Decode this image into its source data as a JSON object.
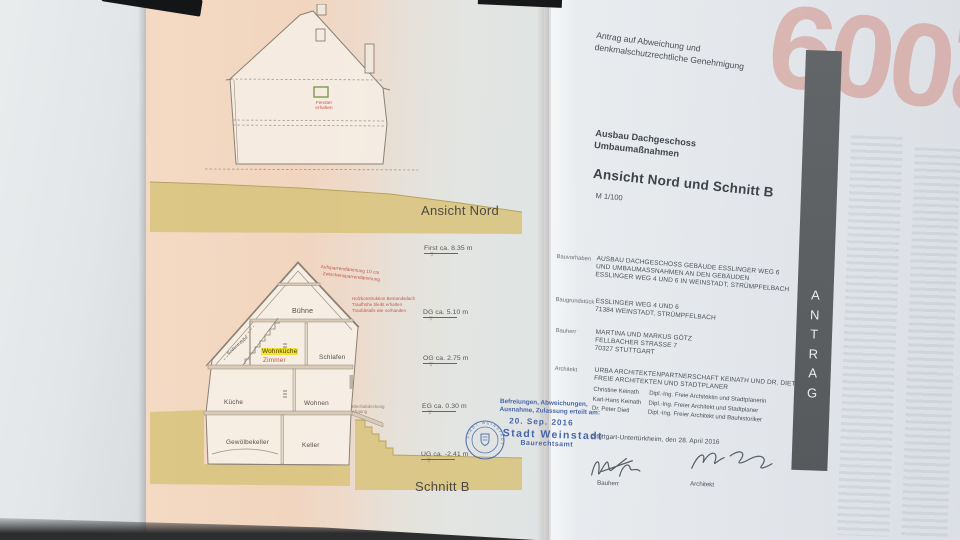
{
  "colors": {
    "page_pink": "#f2d6c0",
    "page_blue_white": "#e4e8ec",
    "ground_ochre": "#d9c480",
    "stamp_blue": "#3b5ca6",
    "annotation_red": "#c0524a",
    "highlight_yellow": "#f2e138",
    "tab_gray": "#5d6163",
    "ghost_red": "#d0867a"
  },
  "elevation": {
    "title": "Ansicht Nord",
    "window_note_line1": "Fenster",
    "window_note_line2": "erhalten"
  },
  "section": {
    "title": "Schnitt B",
    "rooms": {
      "attic": "Bühne",
      "kitchen_living": "Wohnküche",
      "room": "Zimmer",
      "sleeping": "Schlafen",
      "kitchen": "Küche",
      "living": "Wohnen",
      "vault_cellar": "Gewölbekeller",
      "cellar": "Keller",
      "stair": "Bodentreppe"
    },
    "notes": {
      "roof1": "Aufsparrendämmung 10 cm",
      "roof2": "Zwischensparrendämmung",
      "eaves1": "Holzkonstruktion Bestandsdach",
      "eaves2": "Traufhöhe bleibt erhalten",
      "eaves3": "Traufdetails wie vorhanden",
      "exit": "Blechabdeckung Abgang"
    }
  },
  "levels": [
    {
      "name": "First",
      "height": "ca. 8.35 m"
    },
    {
      "name": "DG",
      "height": "ca. 5.10 m"
    },
    {
      "name": "OG",
      "height": "ca. 2.75 m"
    },
    {
      "name": "EG",
      "height": "ca. 0.30 m"
    },
    {
      "name": "UG",
      "height": "ca. -2.41 m"
    }
  ],
  "datum_icon": "▽",
  "stamp": {
    "line1": "Befreiungen, Abweichungen,",
    "line2": "Ausnahme, Zulassung erteilt am:",
    "date": "20. Sep. 2016",
    "authority": "Stadt Weinstadt",
    "office": "Baurechtsamt",
    "seal": "STADT WEINSTADT"
  },
  "form": {
    "request_line1": "Antrag auf Abweichung und",
    "request_line2": "denkmalschutzrechtliche Genehmigung",
    "project_line1": "Ausbau Dachgeschoss",
    "project_line2": "Umbaumaßnahmen",
    "sheet_title": "Ansicht Nord und Schnitt B",
    "scale": "M 1/100",
    "fields": [
      {
        "label": "Bauvorhaben",
        "lines": [
          "AUSBAU DACHGESCHOSS GEBÄUDE ESSLINGER WEG 6",
          "UND UMBAUMASSNAHMEN AN DEN GEBÄUDEN",
          "ESSLINGER WEG 4 UND 6 IN WEINSTADT, STRÜMPFELBACH"
        ]
      },
      {
        "label": "Baugrundstück",
        "lines": [
          "ESSLINGER WEG 4 UND 6",
          "71384 WEINSTADT, STRÜMPFELBACH"
        ]
      },
      {
        "label": "Bauherr",
        "lines": [
          "MARTINA UND MARKUS GÖTZ",
          "FELLBACHER STRASSE 7",
          "70327 STUTTGART"
        ]
      },
      {
        "label": "Architekt",
        "lines": [
          "URBA ARCHITEKTENPARTNERSCHAFT KEINATH UND DR. DIETL",
          "FREIE ARCHITEKTEN UND STADTPLANER"
        ]
      }
    ],
    "team": [
      {
        "name": "Christine Keinath",
        "role": "Dipl.-Ing. Freie Architektin und Stadtplanerin"
      },
      {
        "name": "Karl-Hans Keinath",
        "role": "Dipl.-Ing. Freier Architekt und Stadtplaner"
      },
      {
        "name": "Dr. Peter Dietl",
        "role": "Dipl.-Ing. Freier Architekt und Bauhistoriker"
      }
    ],
    "place_date": "Stuttgart-Untertürkheim, den 28. April 2016",
    "signature_left": "Bauherr",
    "signature_right": "Architekt"
  },
  "side_tab": {
    "label": "ANTRAG",
    "letters": [
      "A",
      "N",
      "T",
      "R",
      "A",
      "G"
    ]
  },
  "background_sheet": {
    "year": "2009"
  }
}
